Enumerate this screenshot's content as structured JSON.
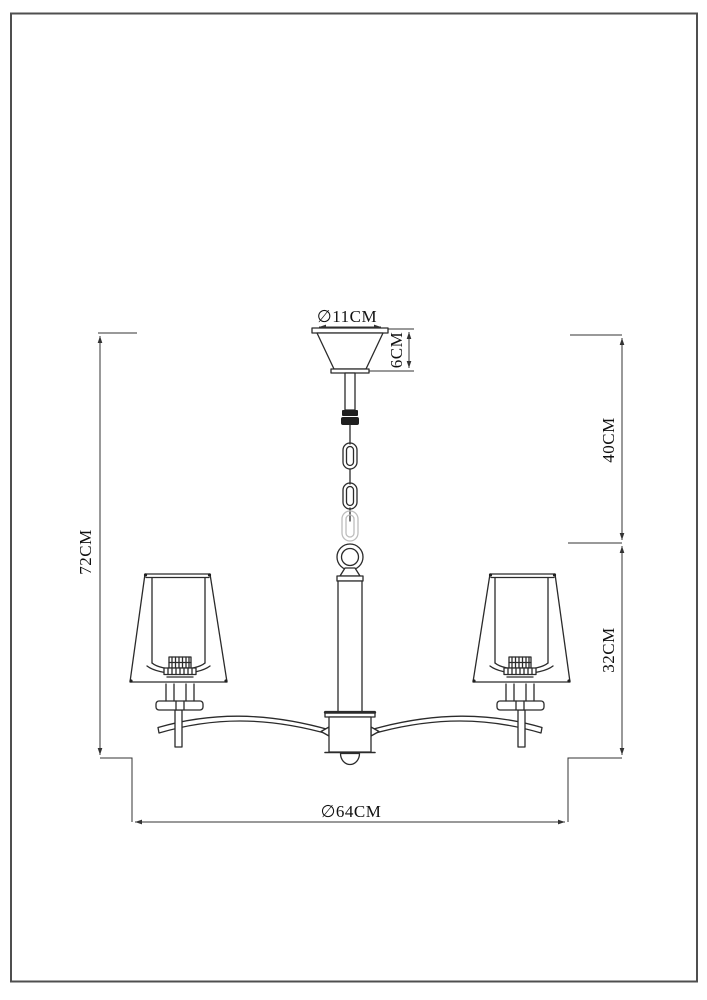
{
  "figure": {
    "type": "technical-dimension-drawing",
    "subject": "two-arm chandelier pendant lamp",
    "background": "#ffffff",
    "line_color": "#2b2b2b",
    "dimension_line_color": "#333333",
    "border_color": "#4f4f4f",
    "faded_link_color": "#bdbdbd"
  },
  "dimensions": {
    "canopy_diameter": "∅11CM",
    "canopy_height": "6CM",
    "suspension_length": "40CM",
    "body_height": "32CM",
    "total_height": "72CM",
    "overall_diameter": "∅64CM"
  }
}
